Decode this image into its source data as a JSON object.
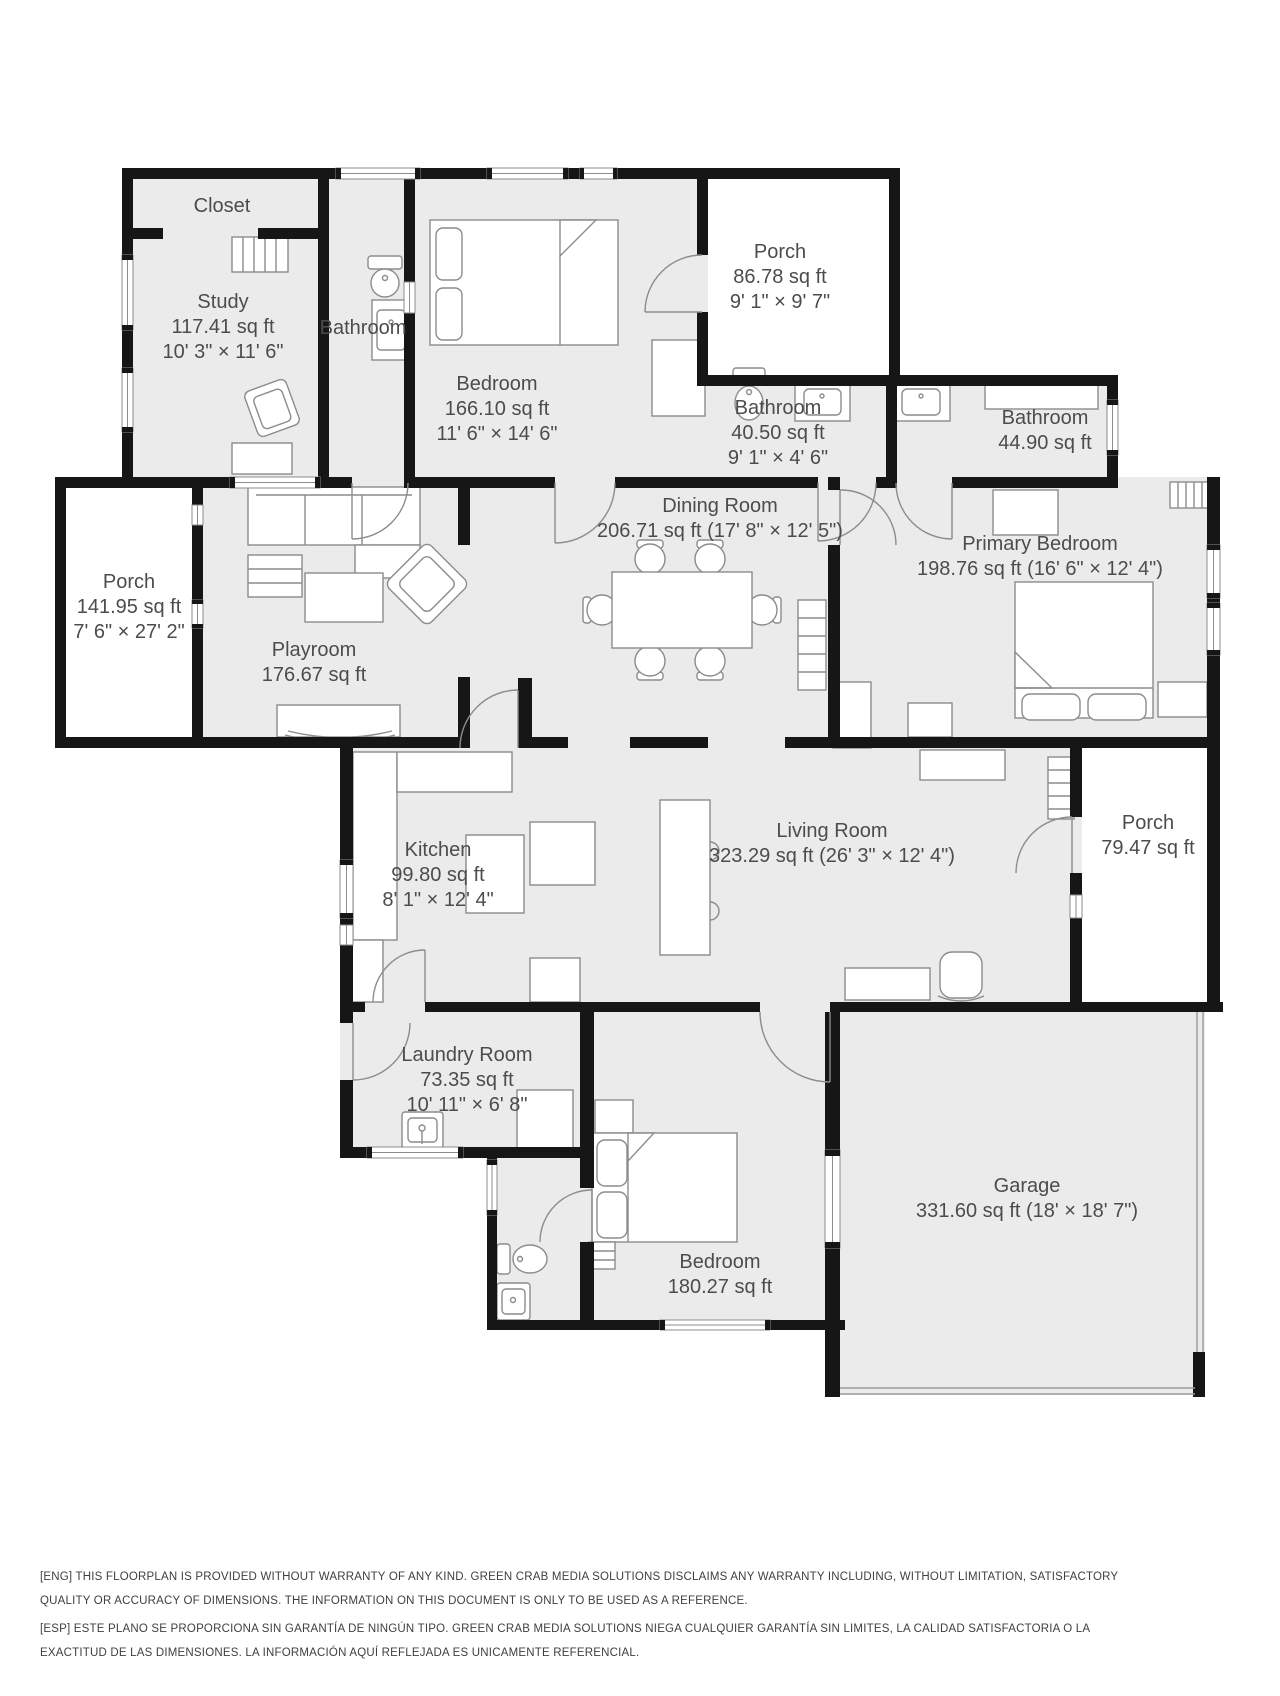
{
  "floorplan": {
    "rooms": [
      {
        "name": "Closet"
      },
      {
        "name": "Study",
        "area": "117.41 sq ft",
        "dims": "10' 3\" × 11' 6\""
      },
      {
        "name": "Bathroom"
      },
      {
        "name": "Bedroom",
        "area": "166.10 sq ft",
        "dims": "11' 6\" × 14' 6\""
      },
      {
        "name": "Porch",
        "area": "86.78 sq ft",
        "dims": "9' 1\" × 9' 7\""
      },
      {
        "name": "Bathroom",
        "area": "40.50 sq ft",
        "dims": "9' 1\" × 4' 6\""
      },
      {
        "name": "Bathroom",
        "area": "44.90 sq ft"
      },
      {
        "name": "Dining Room",
        "area": "206.71 sq ft (17' 8\" × 12' 5\")"
      },
      {
        "name": "Primary Bedroom",
        "area": "198.76 sq ft (16' 6\" × 12' 4\")"
      },
      {
        "name": "Porch",
        "area": "141.95 sq ft",
        "dims": "7' 6\" × 27' 2\""
      },
      {
        "name": "Playroom",
        "area": "176.67 sq ft"
      },
      {
        "name": "Kitchen",
        "area": "99.80 sq ft",
        "dims": "8' 1\" × 12' 4\""
      },
      {
        "name": "Living Room",
        "area": "323.29 sq ft (26' 3\" × 12' 4\")"
      },
      {
        "name": "Porch",
        "area": "79.47 sq ft"
      },
      {
        "name": "Laundry Room",
        "area": "73.35 sq ft",
        "dims": "10' 11\" × 6' 8\""
      },
      {
        "name": "Bedroom",
        "area": "180.27 sq ft"
      },
      {
        "name": "Garage",
        "area": "331.60 sq ft (18' × 18' 7\")"
      }
    ],
    "disclaimer_eng": "[ENG] THIS FLOORPLAN IS PROVIDED WITHOUT WARRANTY OF ANY KIND. GREEN CRAB MEDIA SOLUTIONS DISCLAIMS ANY WARRANTY INCLUDING, WITHOUT LIMITATION, SATISFACTORY QUALITY OR ACCURACY OF DIMENSIONS. THE INFORMATION ON THIS DOCUMENT IS ONLY TO BE USED AS A REFERENCE.",
    "disclaimer_esp": "[ESP] ESTE PLANO SE PROPORCIONA SIN GARANTÍA DE NINGÚN TIPO. GREEN CRAB MEDIA SOLUTIONS NIEGA CUALQUIER GARANTÍA SIN LIMITES, LA CALIDAD SATISFACTORIA O LA EXACTITUD DE LAS DIMENSIONES. LA INFORMACIÓN AQUÍ REFLEJADA ES UNICAMENTE REFERENCIAL.",
    "colors": {
      "wall": "#161616",
      "room_fill": "#ebebeb",
      "label_text": "#4c4c4c",
      "furniture_stroke": "#8c8c8c"
    }
  }
}
